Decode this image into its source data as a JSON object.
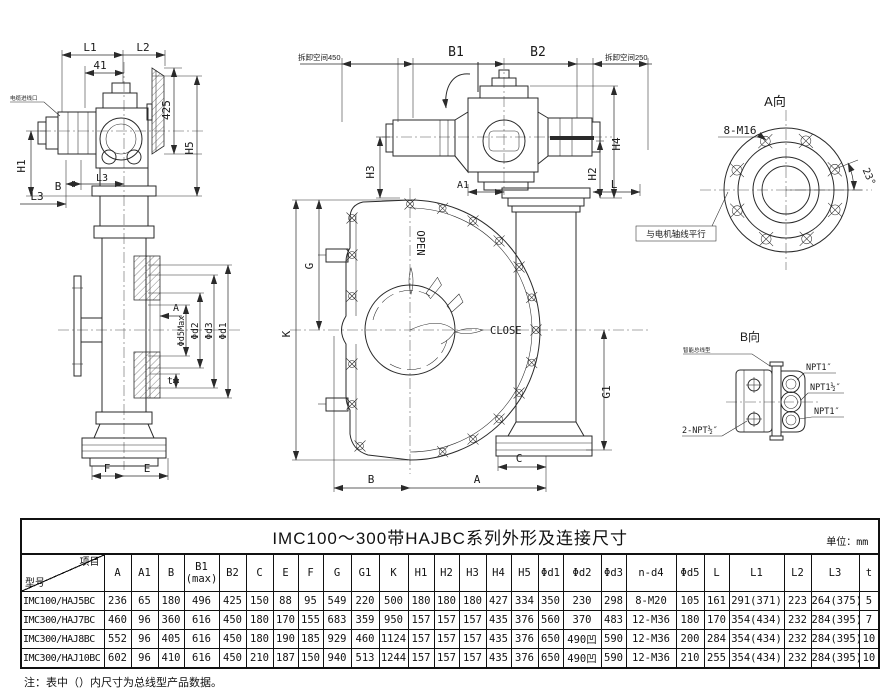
{
  "drawing": {
    "side_view": {
      "l1": "L1",
      "l2": "L2",
      "d41": "41",
      "d425": "425",
      "h5": "H5",
      "h1": "H1",
      "b": "B",
      "l3_mid": "L3",
      "l3_low": "L3",
      "cable_entry": "电缆进线口",
      "a": "A",
      "d5max": "Φd5Max",
      "d2": "Φd2",
      "d3": "Φd3",
      "d1": "Φd1",
      "t": "t",
      "f": "F",
      "e": "E"
    },
    "front_view": {
      "space_left": "拆卸空间450",
      "b1": "B1",
      "b2": "B2",
      "space_right": "拆卸空间250",
      "h3": "H3",
      "h4": "H4",
      "h2": "H2",
      "a1": "A1",
      "l": "L",
      "g": "G",
      "k": "K",
      "g1": "G1",
      "open": "OPEN",
      "close": "CLOSE",
      "c": "C",
      "b": "B",
      "a": "A"
    },
    "view_a": {
      "title": "A向",
      "bolts": "8-M16",
      "angle": "23°",
      "axis_note": "与电机轴线平行"
    },
    "view_b": {
      "title": "B向",
      "type_label": "智能总线型",
      "port_top": "NPT1″",
      "port_mid": "NPT1½″",
      "port_bottom": "NPT1″",
      "rear_ports": "2-NPT½″"
    }
  },
  "table": {
    "title": "IMC100～300带HAJBC系列外形及连接尺寸",
    "unit_label": "单位：",
    "unit": "mm",
    "corner": {
      "top": "项目",
      "bottom": "型号"
    },
    "columns": [
      "A",
      "A1",
      "B",
      "B1\n(max)",
      "B2",
      "C",
      "E",
      "F",
      "G",
      "G1",
      "K",
      "H1",
      "H2",
      "H3",
      "H4",
      "H5",
      "Φd1",
      "Φd2",
      "Φd3",
      "n-d4",
      "Φd5",
      "L",
      "L1",
      "L2",
      "L3",
      "t"
    ],
    "rows": [
      {
        "model": "IMC100/HAJ5BC",
        "values": [
          "236",
          "65",
          "180",
          "496",
          "425",
          "150",
          "88",
          "95",
          "549",
          "220",
          "500",
          "180",
          "180",
          "180",
          "427",
          "334",
          "350",
          "230",
          "298",
          "8-M20",
          "105",
          "161",
          "291(371)",
          "223",
          "264(375)",
          "5"
        ]
      },
      {
        "model": "IMC300/HAJ7BC",
        "values": [
          "460",
          "96",
          "360",
          "616",
          "450",
          "180",
          "170",
          "155",
          "683",
          "359",
          "950",
          "157",
          "157",
          "157",
          "435",
          "376",
          "560",
          "370",
          "483",
          "12-M36",
          "180",
          "170",
          "354(434)",
          "232",
          "284(395)",
          "7"
        ]
      },
      {
        "model": "IMC300/HAJ8BC",
        "values": [
          "552",
          "96",
          "405",
          "616",
          "450",
          "180",
          "190",
          "185",
          "929",
          "460",
          "1124",
          "157",
          "157",
          "157",
          "435",
          "376",
          "650",
          "490凹",
          "590",
          "12-M36",
          "200",
          "284",
          "354(434)",
          "232",
          "284(395)",
          "10"
        ]
      },
      {
        "model": "IMC300/HAJ10BC",
        "values": [
          "602",
          "96",
          "410",
          "616",
          "450",
          "210",
          "187",
          "150",
          "940",
          "513",
          "1244",
          "157",
          "157",
          "157",
          "435",
          "376",
          "650",
          "490凹",
          "590",
          "12-M36",
          "210",
          "255",
          "354(434)",
          "232",
          "284(395)",
          "10"
        ]
      }
    ],
    "note": "注：表中（）内尺寸为总线型产品数据。"
  }
}
